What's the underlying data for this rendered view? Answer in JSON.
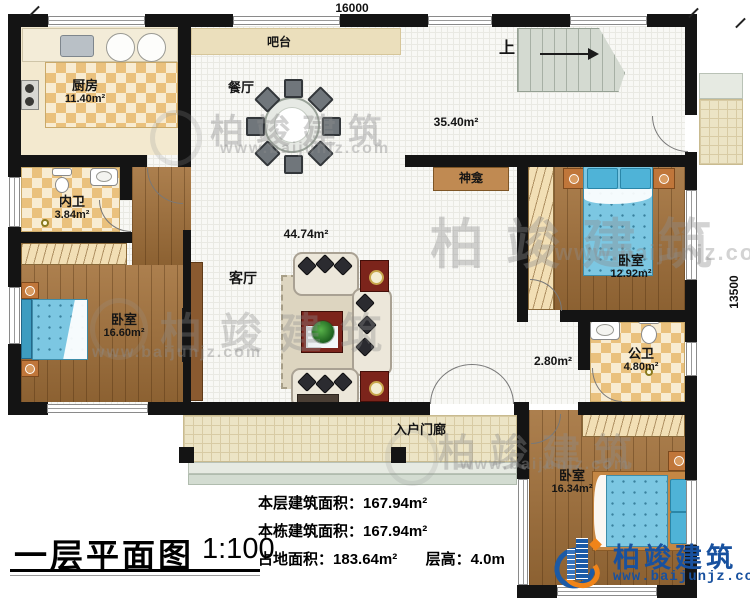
{
  "meta": {
    "title": "一层平面图",
    "scale": "1:100"
  },
  "dimensions": {
    "width": "16000",
    "height": "13500"
  },
  "watermark": {
    "brand": "柏竣建筑",
    "url": "www.baijunjz.com"
  },
  "brand": {
    "name": "柏竣建筑",
    "url": "www.baijunjz.com"
  },
  "stats": {
    "floor_area_label": "本层建筑面积：",
    "floor_area_value": "167.94m²",
    "building_area_label": "本栋建筑面积：",
    "building_area_value": "167.94m²",
    "land_area_label": "占地面积：",
    "land_area_value": "183.64m²",
    "storey_height_label": "层高：",
    "storey_height_value": "4.0m"
  },
  "rooms": {
    "kitchen": {
      "label": "厨房",
      "area": "11.40m²"
    },
    "bar": {
      "label": "吧台"
    },
    "dining": {
      "label": "餐厅",
      "area": "35.40m²"
    },
    "stairs": {
      "label": "上"
    },
    "ensuite_bath": {
      "label": "内卫",
      "area": "3.84m²"
    },
    "shrine": {
      "label": "神龛"
    },
    "bedroom_left": {
      "label": "卧室",
      "area": "16.60m²"
    },
    "living": {
      "label": "客厅",
      "area": "44.74m²"
    },
    "bedroom_right": {
      "label": "卧室",
      "area": "12.92m²"
    },
    "public_bath": {
      "label": "公卫",
      "area": "4.80m²"
    },
    "hallway": {
      "area": "2.80m²"
    },
    "entry_porch": {
      "label": "入户门廊"
    },
    "bedroom_bottom": {
      "label": "卧室",
      "area": "16.34m²"
    }
  }
}
